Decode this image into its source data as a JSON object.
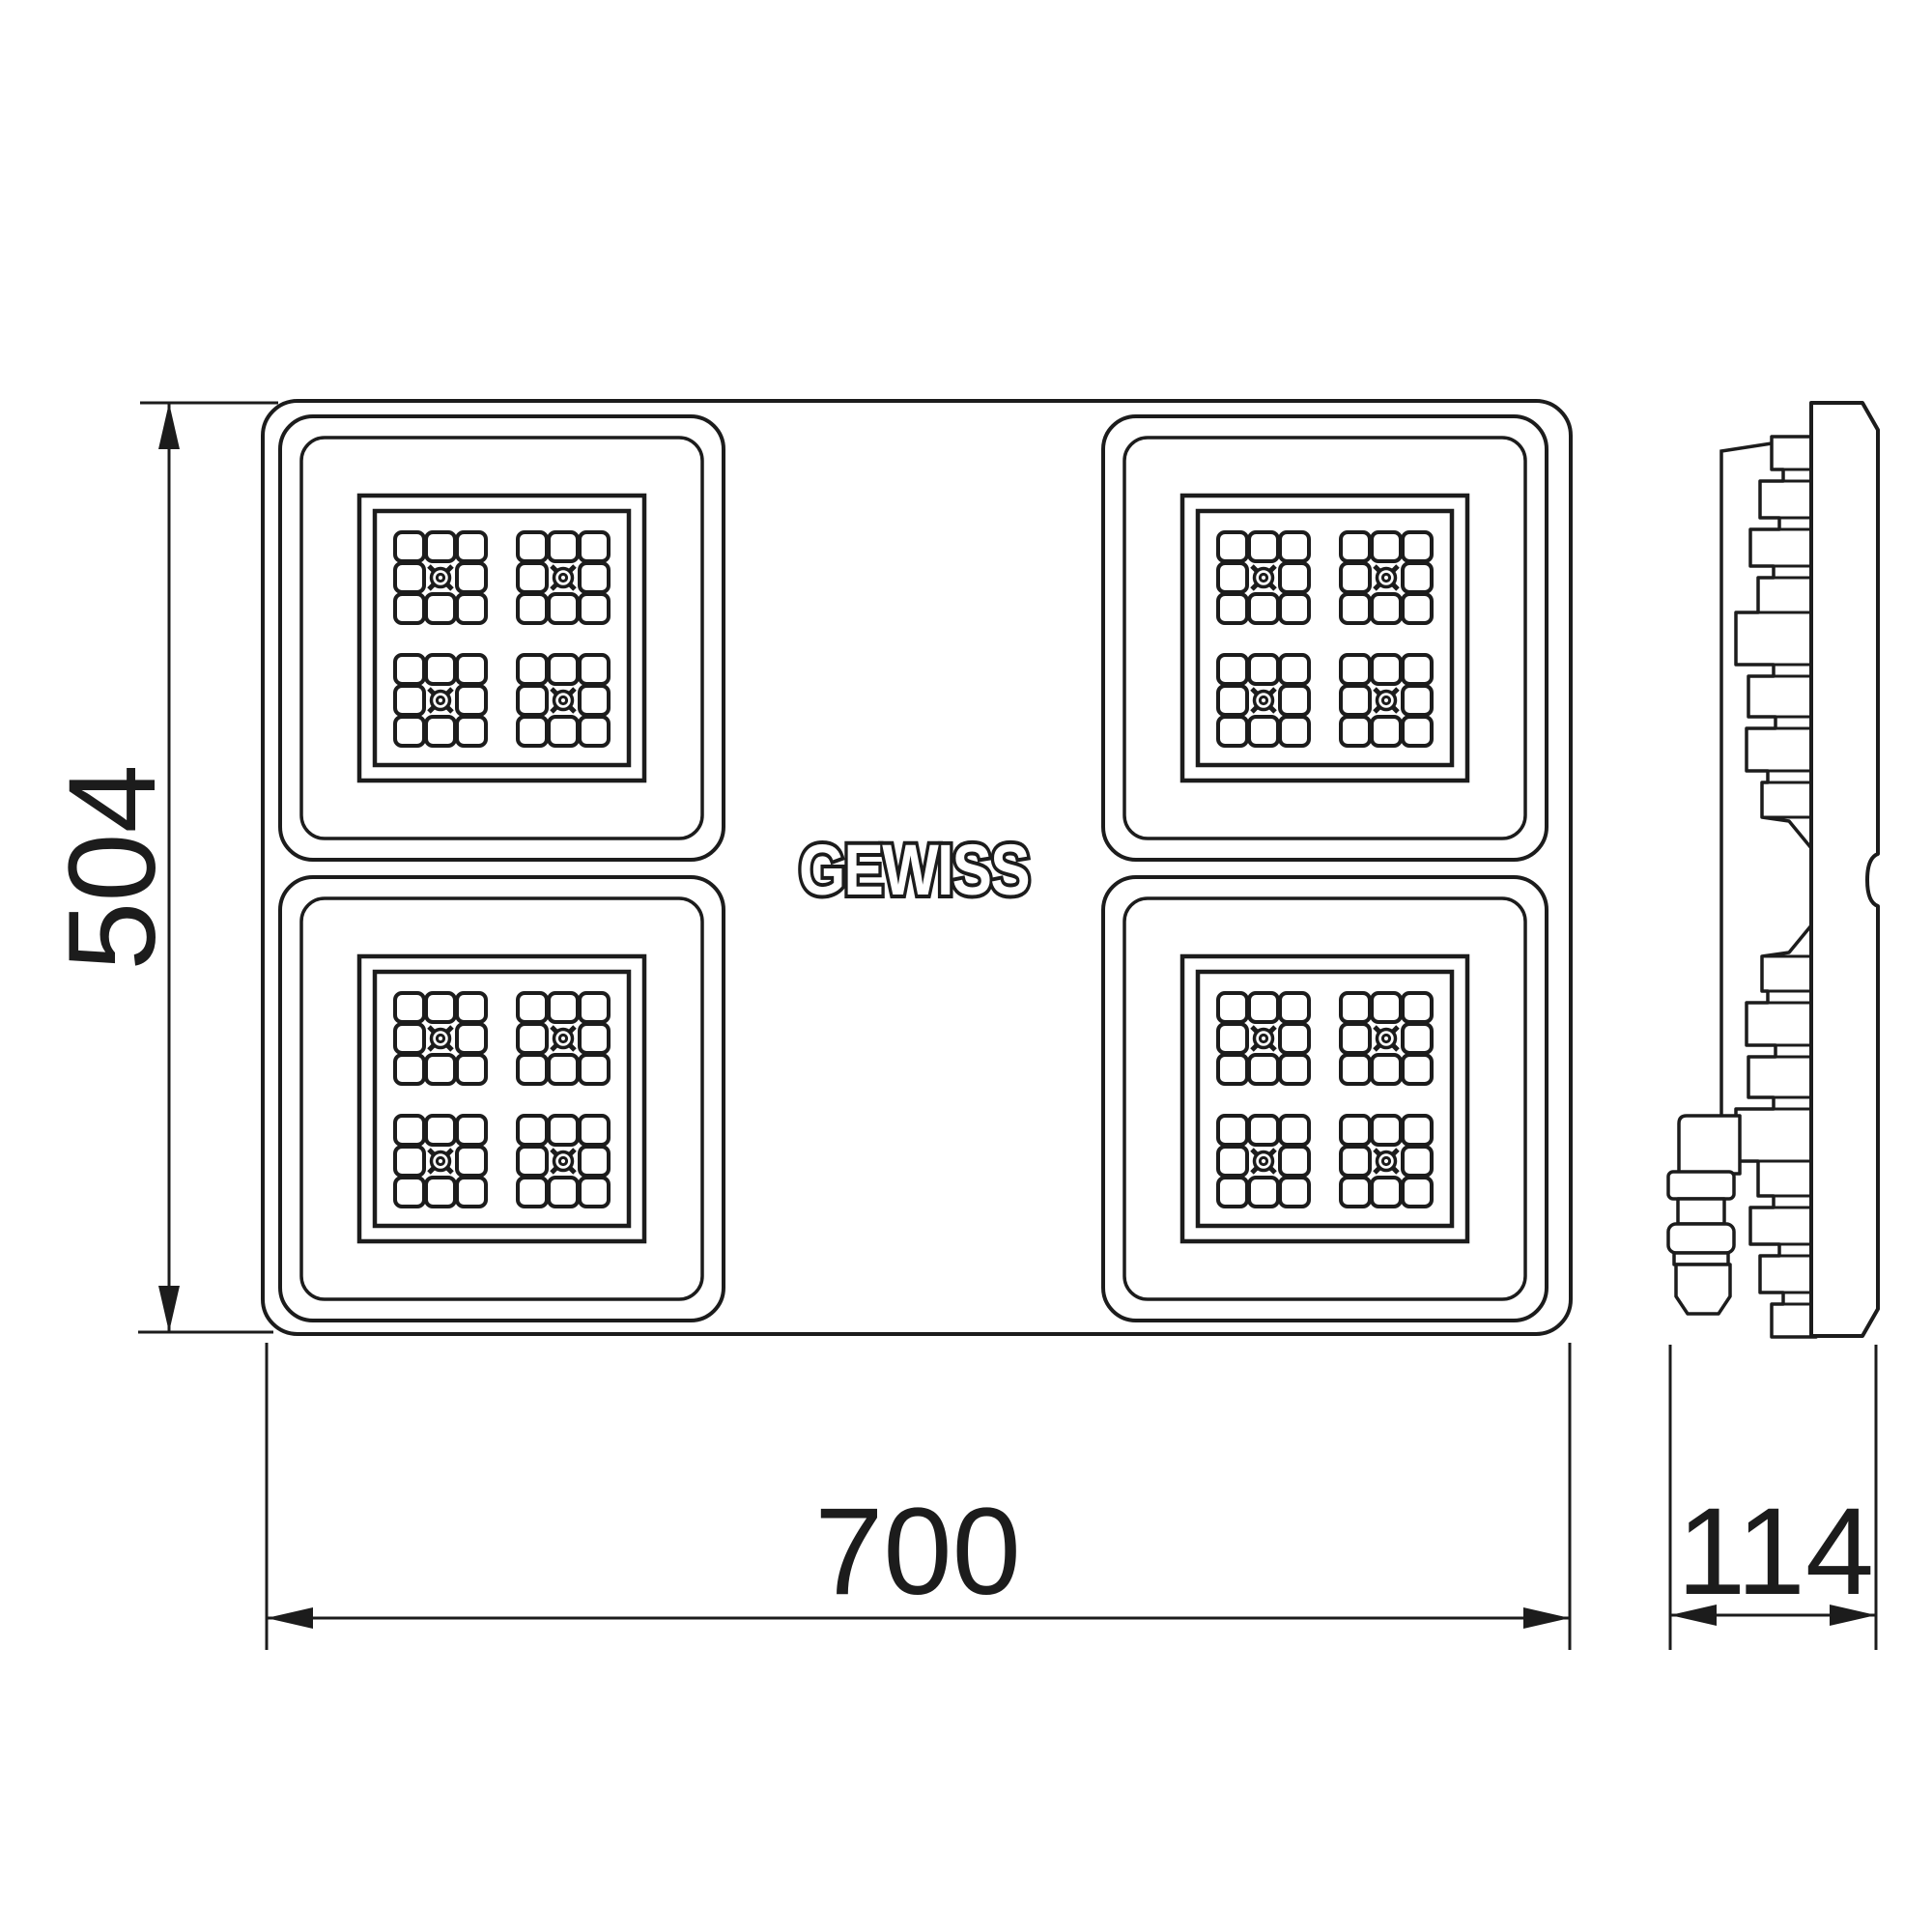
{
  "drawing": {
    "brand_logo": "GEWISS",
    "dimensions": {
      "front_height_mm": "504",
      "front_width_mm": "700",
      "side_depth_mm": "114"
    },
    "colors": {
      "line": "#1c1c1c",
      "background": "#ffffff"
    }
  }
}
